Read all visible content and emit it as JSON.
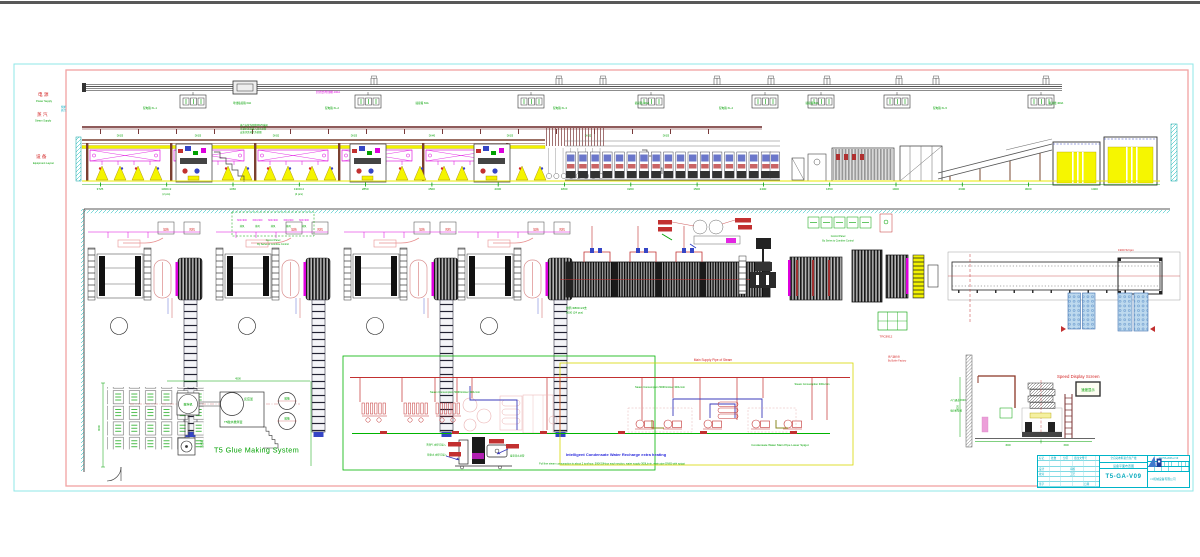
{
  "margin": {
    "power_cn": "电 源",
    "power_en": "Power Supply",
    "steam_cn": "蒸 汽",
    "steam_en": "Steam Supply",
    "equip_cn": "设 备",
    "equip_en": "Equipment Layout",
    "boiler_src_1": "锅炉",
    "boiler_src_2": "供汽"
  },
  "top_band": {
    "busbar_note": "封闭式母线槽 400A",
    "spec_note": [
      "蒸汽支管均预留DN25球阀",
      "冷凝水就近接入回水总管",
      "安装详见蒸汽系统图"
    ],
    "notes": [
      "配电箱 XL-1",
      "母线插接箱 63A",
      "配电箱 XL-2",
      "插接箱 63A",
      "配电箱 XL-3",
      "插接箱 100A",
      "配电箱 XL-4",
      "插接箱 63A",
      "配电箱 XL-5",
      "总进线 400A"
    ],
    "steam_dns": [
      "DN25",
      "DN25",
      "DN32",
      "DN25",
      "DN40",
      "DN25",
      "DN32",
      "DN25"
    ],
    "dims": [
      [
        "3725",
        ""
      ],
      [
        "1300×2",
        "(2 pcs)"
      ],
      [
        "1450",
        ""
      ],
      [
        "1300×4",
        "(4 pcs)"
      ],
      [
        "2850",
        ""
      ],
      [
        "4500",
        ""
      ],
      [
        "2000",
        ""
      ],
      [
        "1800",
        ""
      ],
      [
        "3200",
        ""
      ],
      [
        "1500",
        ""
      ],
      [
        "2400",
        ""
      ],
      [
        "1650",
        ""
      ],
      [
        "1900",
        ""
      ],
      [
        "2600",
        ""
      ],
      [
        "3000",
        ""
      ],
      [
        "1400",
        ""
      ]
    ]
  },
  "plan_band": {
    "heater_label": "加热",
    "fan_label": "风机",
    "params": [
      {
        "v": "600×900",
        "l": "排风"
      },
      {
        "v": "600×900",
        "l": "排风"
      },
      {
        "v": "600×900",
        "l": "排风"
      },
      {
        "v": "600×900",
        "l": "排风"
      },
      {
        "v": "600×900",
        "l": "排风"
      }
    ],
    "caption_1": "Control Panel",
    "caption_2": "By Series to Combine Control",
    "drum_l1": "烘筒 Φ800×24支",
    "drum_l2": "5000 (24 pcs)",
    "rpm_label": "1900 52rpm",
    "table_label": "TRC8912"
  },
  "glue_room": {
    "title": "T5 Glue Making System",
    "mixer": "搅拌机",
    "reactor": "反应釜",
    "tank_note": "T5胶水搅拌釜",
    "drum_1": "胶桶",
    "drum_2": "胶桶",
    "pump_note": "放料泵",
    "dim_w": "4500",
    "dim_h": "9000"
  },
  "schematic": {
    "steam_main": "Main Supply Pipe of Steam",
    "cond_main": "Condensate Water Main Pipe Lower Spigot",
    "blue_title": "Intelligent Condensate Water Recharge extra heating",
    "green_sub": "Full line steam consumption is about 2 ton/hour, 500KG/Hour each section, water supply 300L/min, main pipe DN65 with spigot",
    "cons_1": "Steam Consumption 500KG/Hour 300L/min",
    "cons_2": "Steam Consumption 500KG/Hour 300L/min",
    "cons_3": "Steam Consumption 300L/min",
    "gas_note": "天然气 由甲方接入",
    "water_note": "软化水 由甲方接入",
    "return_note": "接至回水总管",
    "offsite_1": "供汽锅炉房",
    "offsite_2": "By Boiler Factory"
  },
  "speed": {
    "title": "Speed Display Screen",
    "screen": "速度显示",
    "note_1": "人行通道 1500",
    "note_2": "电控柜位置",
    "dim_v": "3000",
    "dim_h1": "3000",
    "dim_h2": "1500"
  },
  "title_block": {
    "rev_labels": [
      "标记",
      "处数",
      "分区",
      "更改文件号",
      "签字",
      "日期"
    ],
    "role_1": "设计",
    "role_2": "校对",
    "role_3": "审核",
    "role_4": "工艺",
    "name_1": "全自动布料复合生产线",
    "name_2": "设备平面布置图",
    "drawing_no": "T5-GA-V09",
    "code": "W2706-2006-2-V9",
    "company": "××机械设备有限公司"
  }
}
